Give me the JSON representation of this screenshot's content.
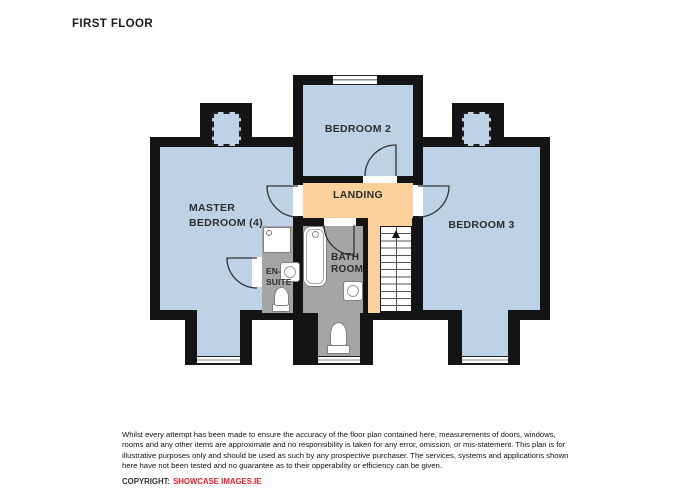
{
  "title": "FIRST FLOOR",
  "plan": {
    "rooms": {
      "bedroom2": {
        "label": "BEDROOM 2"
      },
      "landing": {
        "label": "LANDING"
      },
      "master": {
        "line1": "MASTER",
        "line2": "BEDROOM (4)"
      },
      "bedroom3": {
        "label": "BEDROOM 3"
      },
      "bathroom": {
        "line1": "BATH",
        "line2": "ROOM"
      },
      "ensuite": {
        "line1": "EN-",
        "line2": "SUITE"
      }
    },
    "stairs_direction": "up"
  },
  "colors": {
    "room_fill": "#bdd2e7",
    "landing_fill": "#fbd09b",
    "wet_room_fill": "#a5a5a5",
    "wall": "#141414",
    "copyright_red": "#ed1c24"
  },
  "footer": {
    "disclaimer_lines": [
      "Whilst every attempt has been made to ensure the accuracy of the floor plan contained here, measurements of doors, windows,",
      "rooms and any other items are approximate and no responsibility is taken for any error, omission, or mis-statement.  This plan is for",
      "illustrative purposes only and should be used as such by any prospective purchaser.  The services, systems and applications shown",
      "here have not been tested and no guarantee as to their opperability or efficiency can be given."
    ],
    "copyright_label": "COPYRIGHT:",
    "copyright_brand": "SHOWCASE IMAGES.IE"
  }
}
